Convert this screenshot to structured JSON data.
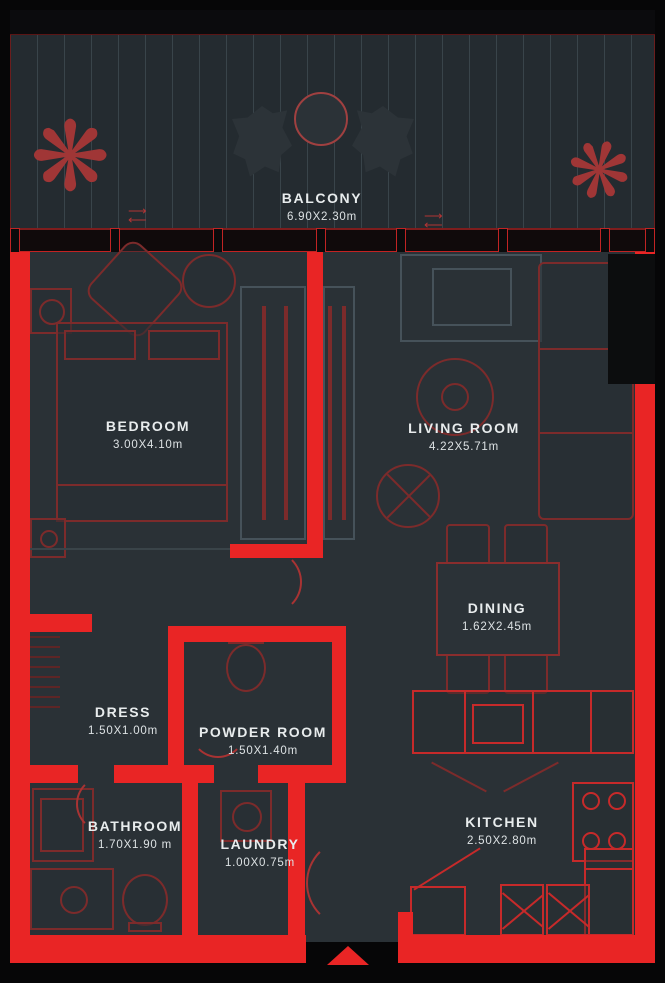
{
  "rooms": [
    {
      "id": "balcony",
      "label": "BALCONY",
      "dims": "6.90X2.30m"
    },
    {
      "id": "bedroom",
      "label": "BEDROOM",
      "dims": "3.00X4.10m"
    },
    {
      "id": "living-room",
      "label": "LIVING ROOM",
      "dims": "4.22X5.71m"
    },
    {
      "id": "dining",
      "label": "DINING",
      "dims": "1.62X2.45m"
    },
    {
      "id": "dress",
      "label": "DRESS",
      "dims": "1.50X1.00m"
    },
    {
      "id": "powder-room",
      "label": "POWDER ROOM",
      "dims": "1.50X1.40m"
    },
    {
      "id": "bathroom",
      "label": "BATHROOM",
      "dims": "1.70X1.90 m"
    },
    {
      "id": "laundry",
      "label": "LAUNDRY",
      "dims": "1.00X0.75m"
    },
    {
      "id": "kitchen",
      "label": "KITCHEN",
      "dims": "2.50X2.80m"
    }
  ],
  "icons": {
    "plant": "❋",
    "slide_arrows": "⟶\n⟵"
  },
  "colors": {
    "wall_red": "#e92525",
    "furniture_outline": "#7c2b2b",
    "kitchen_outline": "#c62a2a",
    "floor": "#2a3136",
    "balcony_floor": "#242b30",
    "label_text": "#e8eced",
    "entry_marker": "#e92525"
  }
}
